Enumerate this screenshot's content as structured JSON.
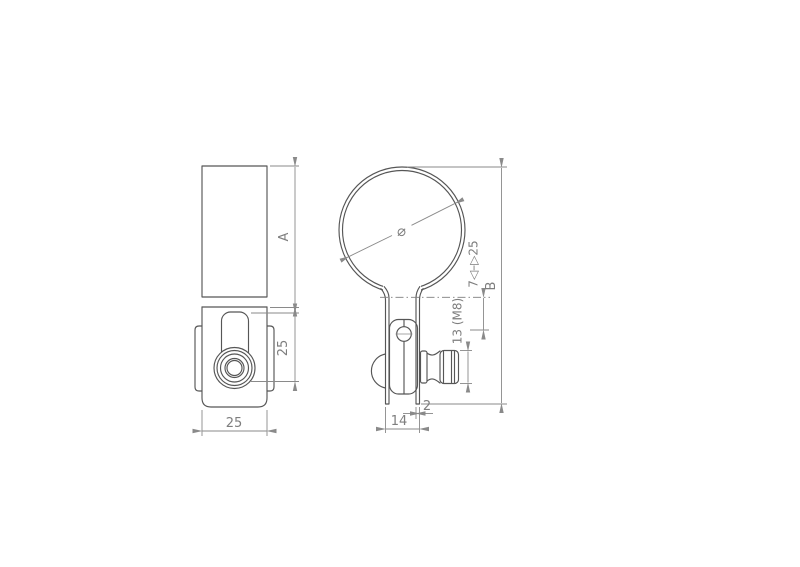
{
  "drawing": {
    "title": "pipe-clamp-two-view-technical-drawing",
    "background_color": "#ffffff",
    "part_line_color": "#565656",
    "dimension_line_color": "#8a8a8a",
    "text_color": "#7e7e7e",
    "views": {
      "front_view": "front-elevation-of-clamp",
      "side_view": "side-elevation-with-clamp-band-circle"
    },
    "dimensions": {
      "height_a": "A",
      "slot_height_25": "25",
      "body_width_25": "25",
      "diameter_symbol": "⌀",
      "clamp_range_7_25": "7◁–▷25",
      "height_b": "B",
      "nut_size": "13 (M8)",
      "strap_thickness_2": "2",
      "leg_spacing_14": "14"
    }
  }
}
